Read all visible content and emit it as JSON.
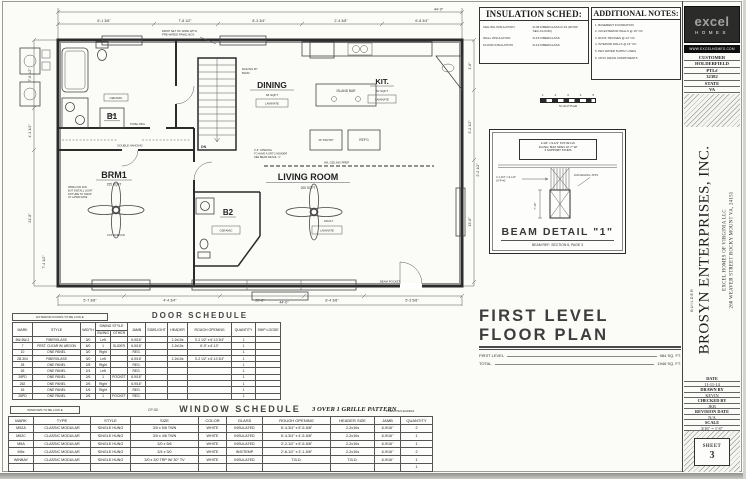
{
  "title_block": {
    "plan_title": "FIRST LEVEL FLOOR PLAN",
    "first_level_label": "FIRST LEVEL",
    "first_level_value": "984 SQ. FT.",
    "total_label": "TOTAL",
    "total_value": "1946 SQ. FT."
  },
  "insulation": {
    "title": "INSULATION SCHED:",
    "rows": [
      [
        "CEILING INSULATION",
        "R-38 FIBERGLASS R-19 (ROOF SEC-FLOOR)"
      ],
      [
        "WALL INSULATION",
        "R-15 FIBERGLASS"
      ],
      [
        "FLOOR INSULATION",
        "R-19 FIBERGLASS"
      ]
    ]
  },
  "notes": {
    "title": "ADDITIONAL NOTES:",
    "items": [
      "1. BASEMENT FOUNDATION",
      "2. 2x6 EXTERIOR WALLS @ 16\" OC",
      "3. ROOF TRUSSES @ 24\" OC",
      "4. INTERIOR WALLS @ 16\" OC",
      "5. PEX WATER SUPPLY LINES",
      "6. CPVC DRAIN COMPONENTS"
    ]
  },
  "scale_bar": {
    "n1": "1",
    "n2": "2",
    "n3": "3",
    "n4": "4",
    "n5": "5",
    "label": "SCALE BAR"
  },
  "beam_detail": {
    "note_1": "1-3/4\" x 9-1/4\" SYP #2 LVL",
    "note_2": "FLUSH, MAX SPAN 13'-7\" W/",
    "note_3": "3 SUPPORT STUDS",
    "left_label_1": "4 1-3/4\" x 9-1/4\"",
    "left_label_2": "SYP #2",
    "right_label": "2x8 CEILING JSTS",
    "dim": "7'-10\"",
    "title": "BEAM DETAIL \"1\"",
    "ref": "BEAM REF:  SECTION 6, PAGE 3"
  },
  "brand": {
    "logo": "excel",
    "logo_sub": "HOMES",
    "website": "WWW.EXCELHOMES.COM",
    "customer_label": "CUSTOMER",
    "customer": "HOLDERFIELD",
    "ptl_label": "PTL#",
    "ptl": "32382",
    "state_label": "STATE",
    "state": "VA"
  },
  "builder": {
    "label": "BUILDER",
    "name": "BROSYN ENTERPRISES, INC.",
    "addr_1": "EXCEL HOMES OF VIRGINIA LLC",
    "addr_2": "260 WEAVER STREET ROCKY MOUNT VA, 24151"
  },
  "sheet_info": {
    "date_label": "DATE",
    "date": "11-11-14",
    "drawn_label": "DRAWN BY",
    "drawn": "KEVIN",
    "checked_label": "CHECKED BY",
    "checked": "JKB",
    "revision_label": "REVISION DATE",
    "revision": "N/A",
    "scale_label": "SCALE",
    "scale": "3/16\" = 1'-0\"",
    "sheet_label": "SHEET",
    "sheet_number": "3"
  },
  "door_schedule": {
    "note": "EXTERIOR DOORS TO BE LOW-E",
    "title": "DOOR SCHEDULE",
    "swing_group": "SWING STYLE",
    "columns": [
      "MARK",
      "STYLE",
      "WIDTH",
      "SWING",
      "OTHER",
      "JAMB",
      "SIDELIGHT",
      "HEADER",
      "ROUGH OPENING",
      "QUANTITY",
      "SHIP LOOSE"
    ],
    "rows": [
      [
        "6W-6W-2",
        "FIBERGLASS",
        "3/0",
        "Left",
        "",
        "6-9/16\"",
        "",
        "2-2x10s",
        "3'-2 1/2\" x 6'-10 3/4\"",
        "1",
        ""
      ],
      [
        "7",
        "FRST. CLEAR W/ ARGON",
        "6/0",
        "1",
        "SLIDER",
        "6-9/16\"",
        "",
        "2-2x10s",
        "6'-0\" x 6'-10\"",
        "1",
        ""
      ],
      [
        "10",
        "ONE PANEL",
        "3/0",
        "Right",
        "",
        "REG.",
        "",
        "",
        "",
        "1",
        ""
      ],
      [
        "2B-304",
        "FIBERGLASS",
        "3/0",
        "Left",
        "",
        "6-9/16\"",
        "",
        "2-2x10s",
        "3'-2 1/2\" x 6'-10 3/4\"",
        "1",
        ""
      ],
      [
        "28",
        "ONE PANEL",
        "2/8",
        "Right",
        "",
        "REG.",
        "",
        "",
        "",
        "1",
        ""
      ],
      [
        "26",
        "ONE PANEL",
        "2/4",
        "Left",
        "",
        "REG.",
        "",
        "",
        "",
        "1",
        ""
      ],
      [
        "26PD",
        "ONE PANEL",
        "2/6",
        "1",
        "POCKET",
        "6-9/16\"",
        "",
        "",
        "",
        "1",
        ""
      ],
      [
        "262",
        "ONE PANEL",
        "2/6",
        "Right",
        "",
        "6-9/16\"",
        "",
        "",
        "",
        "1",
        ""
      ],
      [
        "16",
        "ONE PANEL",
        "1/6",
        "Right",
        "",
        "REG.",
        "",
        "",
        "",
        "1",
        ""
      ],
      [
        "26PD",
        "ONE PANEL",
        "2/6",
        "1",
        "POCKET",
        "REG.",
        "",
        "",
        "",
        "1",
        ""
      ]
    ]
  },
  "window_schedule": {
    "note": "WINDOWS TO BE LOW-E",
    "code": "CP-50",
    "title": "WINDOW SCHEDULE",
    "pattern": "3 OVER 1 GRILLE PATTERN",
    "egress": "# DENOTES EGRESS",
    "columns": [
      "MARK",
      "TYPE",
      "STYLE",
      "SIZE",
      "COLOR",
      "GLASS",
      "ROUGH OPENING",
      "HEADER SIZE",
      "JAMB",
      "QUANTITY"
    ],
    "rows": [
      [
        "M52A",
        "CLASSIC MODULAR",
        "SINGLE HUNG",
        "3/0 x 5/6 TWN",
        "WHITE",
        "INSULATED",
        "6'-4-3/4\" x 5'-5-5/8\"",
        "2-2x10s",
        "6-9/16\"",
        "2"
      ],
      [
        "M52C",
        "CLASSIC MODULAR",
        "SINGLE HUNG",
        "3/0 x 4/6 TWN",
        "WHITE",
        "INSULATED",
        "6'-4-3/4\" x 4'-5-5/8\"",
        "2-2x10s",
        "6-9/16\"",
        "1"
      ],
      [
        "M5A",
        "CLASSIC MODULAR",
        "SINGLE HUNG",
        "3/0 x 5/6",
        "WHITE",
        "INSULATED",
        "3'-2-1/2\" x 5'-5-5/8\"",
        "2-2x10s",
        "6-9/16\"",
        "1"
      ],
      [
        "M5x",
        "CLASSIC MODULAR",
        "SINGLE HUNG",
        "3/4 x 3/0",
        "WHITE",
        "INS/TEMP",
        "2'-6-1/2\" x 3'-1-5/8\"",
        "2-2x10s",
        "6-9/16\"",
        "2"
      ],
      [
        "WINBAY",
        "CLASSIC MODULAR",
        "SINGLE HUNG",
        "3/0 x 3/0 TRP W/ 30° TV",
        "WHITE",
        "INSULATED",
        "T.B.D.",
        "T.B.D.",
        "6-9/16\"",
        "1"
      ],
      [
        "",
        "",
        "",
        "",
        "",
        "",
        "",
        "",
        "",
        "1"
      ]
    ]
  },
  "plan": {
    "rooms": {
      "b1": {
        "name": "B1"
      },
      "brm1": {
        "name": "BRM1",
        "sqft": "155 SQFT"
      },
      "dining": {
        "name": "DINING",
        "sqft": "96 SQFT",
        "floor": "LAMINATE"
      },
      "kit": {
        "name": "KIT.",
        "sqft": "60 SQFT",
        "floor": "LAMINATE"
      },
      "living": {
        "name": "LIVING ROOM",
        "sqft": "205 SQFT",
        "floor": "LAMINATE"
      },
      "b2": {
        "name": "B2",
        "floor": "CERAMIC"
      }
    },
    "annotations": {
      "railing_1": "RAILING BY",
      "railing_2": "BLDR.",
      "double_hanging": "DOUBLE HANGING",
      "island_bar": "ISLAND BAR",
      "refg": "REF'G",
      "pantry": "30\" PANTRY",
      "linen": "LINEN",
      "ceramic": "CERAMIC",
      "towel_ring": "TOWEL RING",
      "future_fan": "FUTURE FAN",
      "fan_lt": "FAN/LT",
      "beam_pocket": "BEAM POCKET",
      "dn": "DN",
      "wire_1": "DROP SET OF WIRE WITH",
      "wire_2": "PRE-WIRED PANEL BOX",
      "open_1": "3'-6\" OPENING",
      "open_2": "TO HAVE A GRT-2 HEADER",
      "open_3": "SEE BEAM DETAIL \"1\"",
      "ceiling_prep": "W/L CEILING PREP",
      "fan_note_1": "WIRE FOR FAN",
      "fan_note_2": "BUT INSTALL LIGHT",
      "fan_note_3": "FIXTURE TO SWAP",
      "fan_note_4": "AT LATER DATE"
    },
    "dims": [
      "44'-0\"",
      "6'-1 3/8\"",
      "7'-8 1/2\"",
      "8'-3 3/4\"",
      "2'-4 3/8\"",
      "6'-8 3/4\"",
      "7'-6 1/2\"",
      "4'-1 1/4\"",
      "21'-8\"",
      "7'-4 1/2\"",
      "1'-6\"",
      "3'-2 1/2\"",
      "13'-6\"",
      "5'-7 3/8\"",
      "4'-4 3/4\"",
      "8'-4 3/8\"",
      "5'-3 5/8\"",
      "44'-0\"",
      "20'-8\"",
      "2'-2 1/2\""
    ]
  }
}
